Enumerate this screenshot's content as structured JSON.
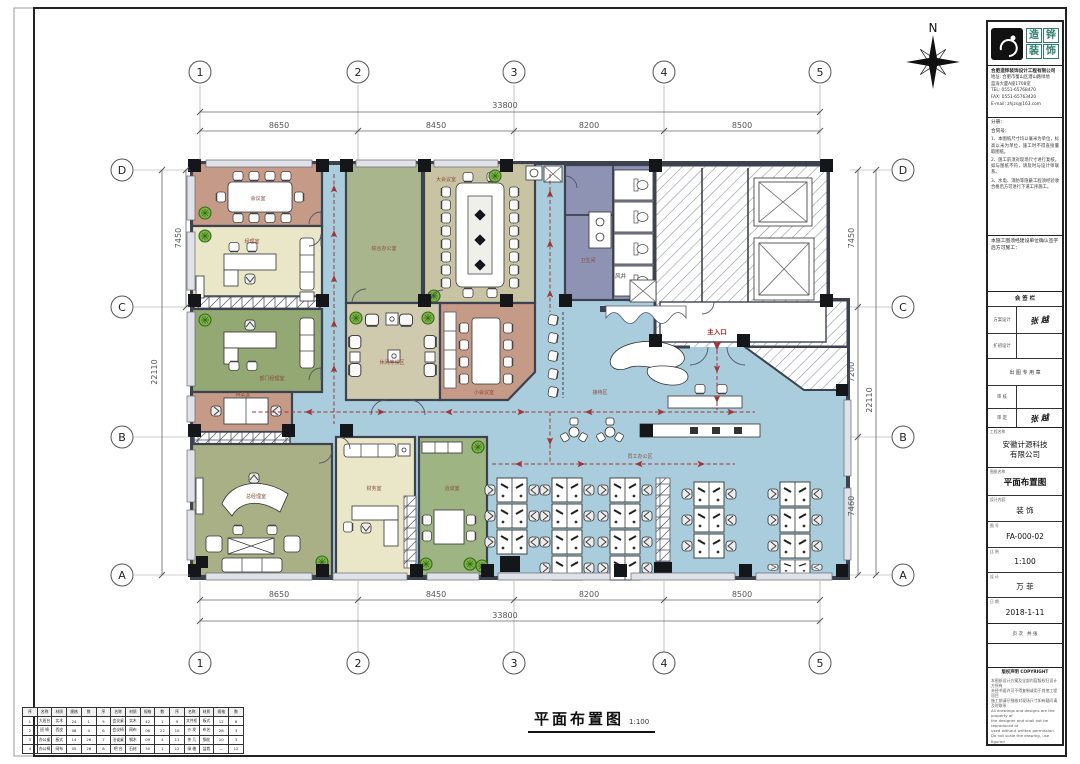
{
  "page": {
    "drawing_title": "平面布置图",
    "scale": "1:100"
  },
  "north": {
    "label": "N"
  },
  "grid": {
    "cols": [
      "1",
      "2",
      "3",
      "4",
      "5"
    ],
    "rows": [
      "D",
      "C",
      "B",
      "A"
    ]
  },
  "dims": {
    "top_total": "33800",
    "top": [
      "8650",
      "8450",
      "8200",
      "8500"
    ],
    "bottom_total": "33800",
    "bottom": [
      "8650",
      "8450",
      "8200",
      "8500"
    ],
    "left_total": "22110",
    "left_seg": "7450",
    "right": [
      "7450",
      "7200",
      "7460"
    ],
    "right_total": "22110"
  },
  "plan_labels": {
    "main_entrance": "主入口",
    "air_shaft": "风井"
  },
  "rooms": [
    {
      "name": "会议室"
    },
    {
      "name": "经理室"
    },
    {
      "name": "部门经理室"
    },
    {
      "name": "档案室"
    },
    {
      "name": "总经理室"
    },
    {
      "name": "财务室"
    },
    {
      "name": "洽谈室"
    },
    {
      "name": "综合办公室"
    },
    {
      "name": "大会议室"
    },
    {
      "name": "休闲等候区"
    },
    {
      "name": "小会议室"
    },
    {
      "name": "卫生间"
    },
    {
      "name": "接待区"
    },
    {
      "name": "员工办公区"
    }
  ],
  "titleblock": {
    "brand": {
      "chars": [
        "造",
        "铧",
        "装",
        "饰"
      ]
    },
    "contact": {
      "company": "合肥造铧装饰设计工程有限公司",
      "addr1": "地址: 合肥市蜀山区潜山路绿地",
      "addr2": "蓝海大厦A座1708室",
      "tel": "TEL: 0551-65768470",
      "fax": "FAX: 0551-65763420",
      "email": "E-mail: zhjzs@163.com"
    },
    "notes_label1": "分册：",
    "notes_label2": "合同号：",
    "notes": [
      "1、本图纸尺寸均以毫米为单位，标高以米为单位，施工时不得直接量取图纸。",
      "2、施工前须对现场尺寸进行复核，如与图纸不符，请及时与设计师联系。",
      "3、水电、消防等隐蔽工程须经验收合格后方可进行下道工序施工。"
    ],
    "confirm": "本施工图须经建设单位确认签字后方可施工：",
    "sign": {
      "header": "会 签 栏",
      "stamp": "出 图 专 用 章",
      "rows": [
        {
          "label": "方案设计",
          "value": "张 越"
        },
        {
          "label": "扩初设计",
          "value": ""
        },
        {
          "label": "审  核",
          "value": ""
        },
        {
          "label": "审  定",
          "value": "张 越"
        }
      ]
    },
    "project": {
      "name_label": "工程名称",
      "name1": "安徽计源科技",
      "name2": "有限公司",
      "drawing_label": "图纸名称",
      "drawing": "平面布置图",
      "stage_label": "设计内容",
      "stage": "装 饰",
      "no_label": "图 号",
      "no": "FA-000-02",
      "scale_label": "比 例",
      "scale": "1:100",
      "designer_label": "设 计",
      "designer": "万 菲",
      "date_label": "日 期",
      "date": "2018-1-11",
      "page_label": "页 次",
      "page_value": "共  张"
    },
    "footer_title": "版权声明 COPYRIGHT",
    "footer_lines": [
      "本图纸设计方案及全部内容版权归设计方所有",
      "未经书面许可不得复制或用于其他工程项目",
      "施工前请仔细核对现场尺寸如有疑问请及时联系",
      "All drawings and designs are the property of",
      "the designer and shall not be reproduced or",
      "used without written permission.",
      "Do not scale the drawing, use figured",
      "dimensions only. Report any discrepancy."
    ]
  },
  "legend": {
    "headers": [
      "序",
      "名称",
      "材质",
      "规格",
      "数",
      "序",
      "名称",
      "材质",
      "规格",
      "数",
      "序",
      "名称",
      "材质",
      "规格",
      "数"
    ],
    "rows": [
      [
        "1",
        "大班台",
        "实木",
        "24",
        "1",
        "5",
        "会议桌",
        "实木",
        "42",
        "1",
        "9",
        "文件柜",
        "板式",
        "12",
        "8"
      ],
      [
        "2",
        "班 椅",
        "西皮",
        "08",
        "4",
        "6",
        "会议椅",
        "网布",
        "06",
        "22",
        "10",
        "沙 发",
        "布艺",
        "28",
        "3"
      ],
      [
        "3",
        "办公桌",
        "板式",
        "14",
        "26",
        "7",
        "洽谈桌",
        "钢木",
        "09",
        "4",
        "11",
        "茶 几",
        "钢化",
        "10",
        "3"
      ],
      [
        "4",
        "办公椅",
        "网布",
        "05",
        "26",
        "8",
        "吧 台",
        "石材",
        "30",
        "1",
        "12",
        "绿 植",
        "盆栽",
        "—",
        "12"
      ]
    ]
  }
}
